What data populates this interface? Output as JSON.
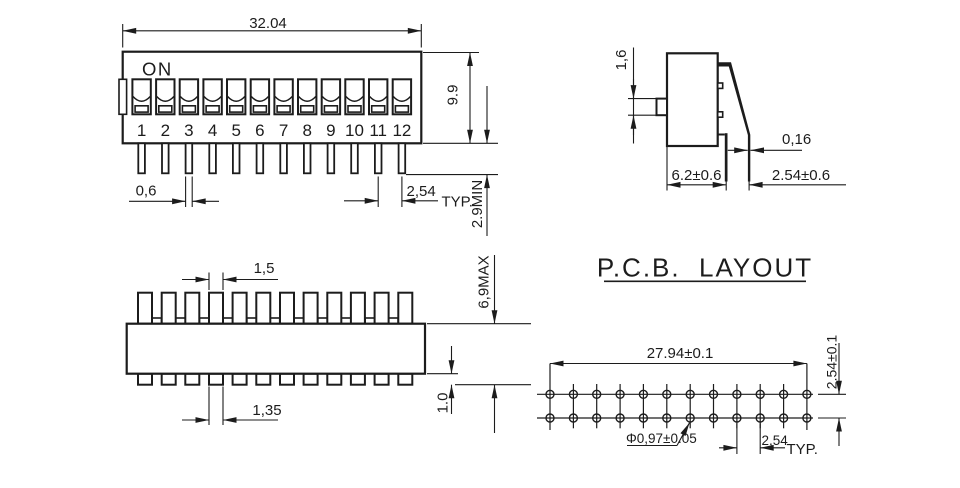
{
  "drawing": {
    "front_view": {
      "on_label": "ON",
      "switch_numbers": [
        "1",
        "2",
        "3",
        "4",
        "5",
        "6",
        "7",
        "8",
        "9",
        "10",
        "11",
        "12"
      ],
      "dim_width": "32.04",
      "dim_height": "9.9",
      "dim_pin_thickness": "0,6",
      "dim_pin_pitch": "2,54",
      "dim_pin_pitch_suffix": "TYP.",
      "dim_pin_length": "2.9MIN"
    },
    "side_view": {
      "dim_actuator_height": "1,6",
      "dim_terminal_thickness": "0,16",
      "dim_body_depth": "6.2±0.6",
      "dim_terminal_spacing": "2.54±0.6"
    },
    "top_view": {
      "dim_actuator_width": "1,5",
      "dim_terminal_width": "1,35",
      "dim_overall_height": "6,9MAX",
      "dim_terminal_height": "1.0"
    },
    "pcb_layout": {
      "title": "P.C.B.  LAYOUT",
      "dim_span": "27.94±0.1",
      "dim_row_pitch": "2.54±0.1",
      "dim_hole_diameter": "Φ0,97±0.05",
      "dim_col_pitch": "2,54",
      "dim_col_pitch_suffix": "TYP."
    },
    "colors": {
      "line": "#1c1c1c",
      "background": "#ffffff"
    }
  }
}
